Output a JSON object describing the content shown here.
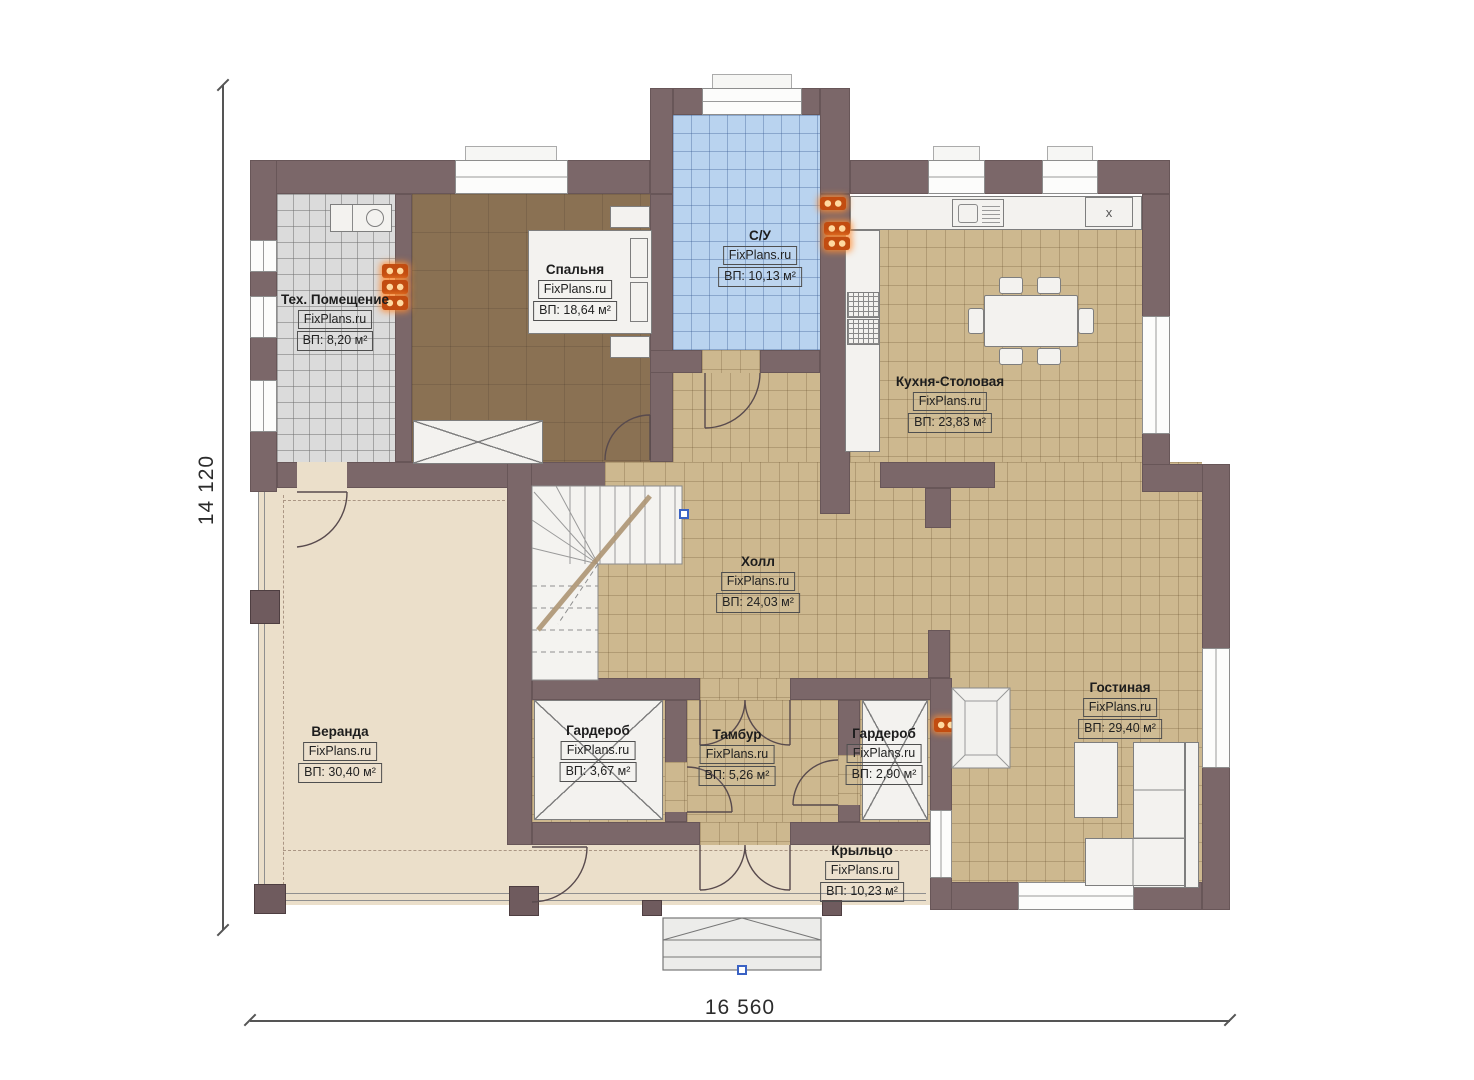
{
  "watermark": "FixPlans.ru",
  "dimensions": {
    "height": "14 120",
    "width": "16 560"
  },
  "kitchen_appliance_label": "x",
  "rooms": [
    {
      "key": "tech",
      "name": "Тех. Помещение",
      "area": "ВП: 8,20 м²"
    },
    {
      "key": "bedroom",
      "name": "Спальня",
      "area": "ВП: 18,64 м²"
    },
    {
      "key": "bathroom",
      "name": "С/У",
      "area": "ВП: 10,13 м²"
    },
    {
      "key": "kitchen",
      "name": "Кухня-Столовая",
      "area": "ВП: 23,83 м²"
    },
    {
      "key": "hall",
      "name": "Холл",
      "area": "ВП: 24,03 м²"
    },
    {
      "key": "veranda",
      "name": "Веранда",
      "area": "ВП: 30,40 м²"
    },
    {
      "key": "wardrobe_left",
      "name": "Гардероб",
      "area": "ВП: 3,67 м²"
    },
    {
      "key": "tambour",
      "name": "Тамбур",
      "area": "ВП: 5,26 м²"
    },
    {
      "key": "wardrobe_right",
      "name": "Гардероб",
      "area": "ВП: 2,90 м²"
    },
    {
      "key": "living",
      "name": "Гостиная",
      "area": "ВП: 29,40 м²"
    },
    {
      "key": "porch",
      "name": "Крыльцо",
      "area": "ВП: 10,23 м²"
    }
  ],
  "colors": {
    "wall": "#7b6769",
    "floor_tile": "#cdb88f",
    "floor_bath": "#b9d3ef",
    "floor_tech": "#dbdbdb",
    "floor_bedroom": "#8a7153",
    "floor_veranda": "#ebdfca",
    "radiator_glow": "#e06010",
    "marker_blue": "#3a62c4"
  }
}
